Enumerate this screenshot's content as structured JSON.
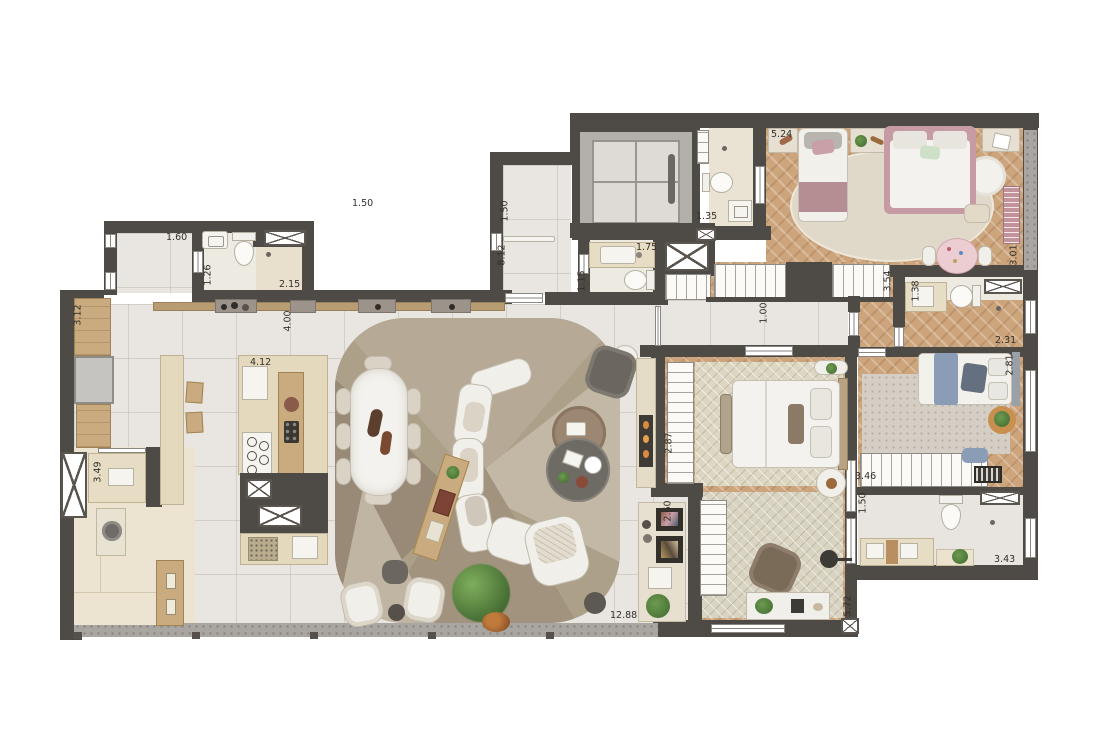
{
  "plan": {
    "type": "apartment-floor-plan",
    "visible_text_note": "floor plan contains only dimension annotations (meters)",
    "palette": {
      "wall": "#4e4a45",
      "floor_tile": "#e9e6e1",
      "floor_wood": "#cda57d",
      "floor_bath": "#edeae1",
      "laundry_beige": "#ece4d0",
      "balcony_band": "#a9a5a0",
      "rug_living": "#ada089",
      "accent_pink": "#c9989e",
      "accent_blue": "#8a9cb6",
      "counter_wood": "#c9ab7f"
    },
    "icons": [
      "elevator-shaft",
      "duct-x-shaft",
      "wardrobe-hatch",
      "window-band",
      "washer-drum",
      "cooktop-burners",
      "fireplace-flames"
    ],
    "dimensions": [
      {
        "label": "1.60",
        "x": 166,
        "y": 233,
        "rot": 0
      },
      {
        "label": "1.26",
        "x": 198,
        "y": 270,
        "rot": 90
      },
      {
        "label": "2.15",
        "x": 279,
        "y": 280,
        "rot": 0
      },
      {
        "label": "3.12",
        "x": 68,
        "y": 310,
        "rot": 90
      },
      {
        "label": "4.00",
        "x": 278,
        "y": 316,
        "rot": 90
      },
      {
        "label": "4.12",
        "x": 250,
        "y": 358,
        "rot": 0
      },
      {
        "label": "3.49",
        "x": 88,
        "y": 467,
        "rot": 90
      },
      {
        "label": "1.50",
        "x": 352,
        "y": 199,
        "rot": 0
      },
      {
        "label": "1.50",
        "x": 495,
        "y": 206,
        "rot": 90
      },
      {
        "label": "8.12",
        "x": 492,
        "y": 250,
        "rot": 90
      },
      {
        "label": "1.75",
        "x": 636,
        "y": 243,
        "rot": 0
      },
      {
        "label": "1.15",
        "x": 572,
        "y": 276,
        "rot": 90
      },
      {
        "label": "1.35",
        "x": 696,
        "y": 212,
        "rot": 0
      },
      {
        "label": "5.24",
        "x": 771,
        "y": 130,
        "rot": 0
      },
      {
        "label": "3.01",
        "x": 1004,
        "y": 250,
        "rot": 90
      },
      {
        "label": "3.54",
        "x": 878,
        "y": 276,
        "rot": 90
      },
      {
        "label": "1.38",
        "x": 906,
        "y": 286,
        "rot": 90
      },
      {
        "label": "1.00",
        "x": 754,
        "y": 308,
        "rot": 90
      },
      {
        "label": "2.31",
        "x": 995,
        "y": 336,
        "rot": 0
      },
      {
        "label": "2.81",
        "x": 1000,
        "y": 360,
        "rot": 90
      },
      {
        "label": "3.46",
        "x": 855,
        "y": 472,
        "rot": 0
      },
      {
        "label": "1.50",
        "x": 853,
        "y": 498,
        "rot": 90
      },
      {
        "label": "3.43",
        "x": 994,
        "y": 555,
        "rot": 0
      },
      {
        "label": "2.87",
        "x": 659,
        "y": 438,
        "rot": 90
      },
      {
        "label": "2.60",
        "x": 658,
        "y": 506,
        "rot": 90
      },
      {
        "label": "5.72",
        "x": 838,
        "y": 601,
        "rot": 90
      },
      {
        "label": "12.88",
        "x": 610,
        "y": 611,
        "rot": 0
      }
    ]
  }
}
